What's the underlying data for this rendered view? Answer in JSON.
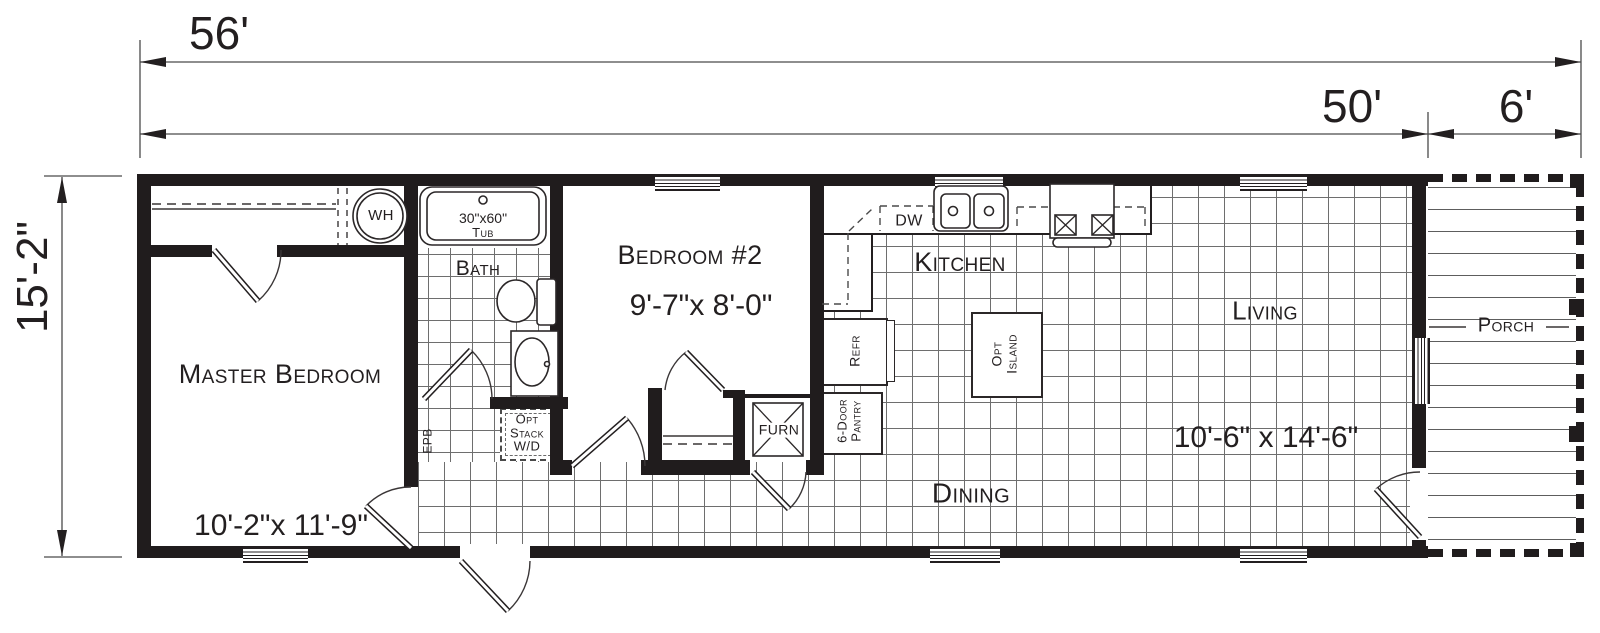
{
  "title": "Single-wide home floor plan",
  "colors": {
    "ink": "#231f20",
    "wall": "#201c1d",
    "grid_line": "#6e6e6e",
    "background": "#ffffff"
  },
  "dimensions": {
    "overall_length": "56'",
    "main_length": "50'",
    "porch_length": "6'",
    "width": "15'-2\""
  },
  "rooms": {
    "master_bedroom": {
      "name": "Master Bedroom",
      "size": "10'-2\"x 11'-9\""
    },
    "bedroom_2": {
      "name": "Bedroom #2",
      "size": "9'-7\"x 8'-0\""
    },
    "bath": {
      "name": "Bath"
    },
    "kitchen": {
      "name": "Kitchen"
    },
    "dining": {
      "name": "Dining"
    },
    "living": {
      "name": "Living",
      "size": "10'-6\" x 14'-6\""
    },
    "porch": {
      "name": "Porch"
    }
  },
  "labels": {
    "water_heater": "WH",
    "tub_size": "30\"x60\"",
    "tub": "Tub",
    "dishwasher": "DW",
    "refrigerator": "Refr",
    "island_line1": "Opt",
    "island_line2": "Island",
    "pantry_line1": "6-Door",
    "pantry_line2": "Pantry",
    "furnace": "FURN",
    "washer_dryer_line1": "Opt",
    "washer_dryer_line2": "Stack",
    "washer_dryer_line3": "W/D",
    "electrical_panel": "EPB"
  }
}
